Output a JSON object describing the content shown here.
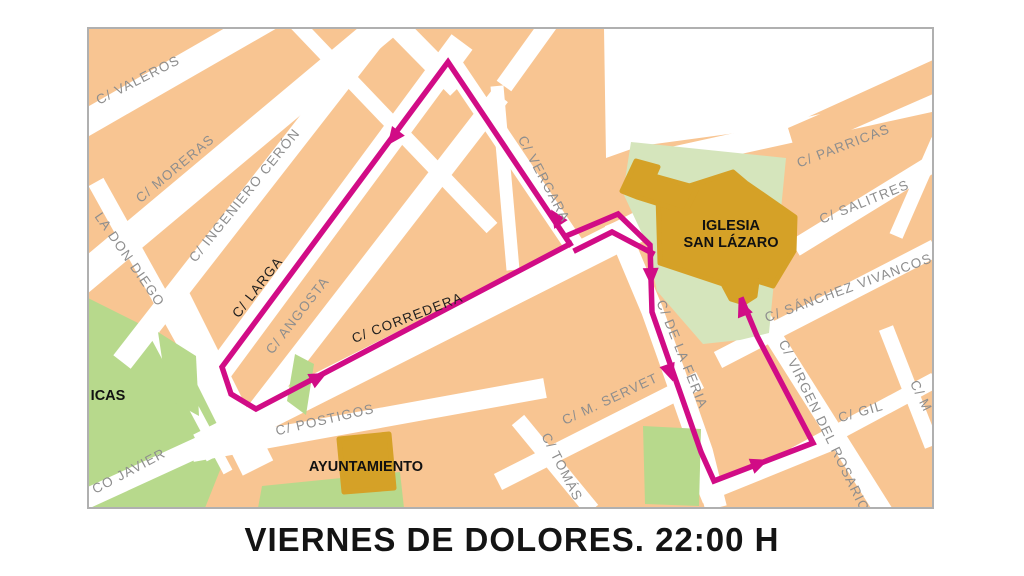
{
  "title": "VIERNES DE DOLORES. 22:00 H",
  "colors": {
    "block_orange": "#f8c592",
    "plaza_green": "#b7d98c",
    "pale_green": "#d5e5bc",
    "building_gold": "#d5a127",
    "street_white": "#ffffff",
    "route_magenta": "#d10c86",
    "label_gray": "#8e8e8e",
    "label_black": "#1f1f1f",
    "poi_black": "#111111",
    "frame_border": "#b0b0b0"
  },
  "map": {
    "frame": {
      "x": 88,
      "y": 28,
      "w": 845,
      "h": 480
    },
    "greens_under": [
      {
        "name": "plaza-green-west",
        "points": [
          [
            88,
            298
          ],
          [
            152,
            330
          ],
          [
            212,
            392
          ],
          [
            232,
            440
          ],
          [
            205,
            508
          ],
          [
            88,
            508
          ]
        ]
      }
    ],
    "streets": [
      {
        "name": "street-valeros",
        "pts": [
          [
            70,
            132
          ],
          [
            272,
            16
          ]
        ],
        "w": 26
      },
      {
        "name": "street-moreras",
        "pts": [
          [
            66,
            292
          ],
          [
            398,
            14
          ]
        ],
        "w": 30
      },
      {
        "name": "street-ingeniero-ceron",
        "pts": [
          [
            122,
            362
          ],
          [
            390,
            18
          ]
        ],
        "w": 22
      },
      {
        "name": "street-larga",
        "pts": [
          [
            205,
            390
          ],
          [
            462,
            42
          ]
        ],
        "w": 26
      },
      {
        "name": "street-angosta",
        "pts": [
          [
            248,
            422
          ],
          [
            500,
            96
          ]
        ],
        "w": 20
      },
      {
        "name": "street-corredera",
        "pts": [
          [
            200,
            448
          ],
          [
            648,
            222
          ]
        ],
        "w": 30
      },
      {
        "name": "street-vergara",
        "pts": [
          [
            448,
            58
          ],
          [
            580,
            254
          ]
        ],
        "w": 20
      },
      {
        "name": "street-top-1",
        "pts": [
          [
            393,
            22
          ],
          [
            458,
            88
          ]
        ],
        "w": 22
      },
      {
        "name": "street-top-2",
        "pts": [
          [
            550,
            22
          ],
          [
            504,
            86
          ]
        ],
        "w": 18
      },
      {
        "name": "street-mid-vert",
        "pts": [
          [
            497,
            86
          ],
          [
            513,
            270
          ]
        ],
        "w": 13
      },
      {
        "name": "street-cross-nw",
        "pts": [
          [
            295,
            22
          ],
          [
            492,
            228
          ]
        ],
        "w": 15
      },
      {
        "name": "street-don-diego",
        "pts": [
          [
            96,
            182
          ],
          [
            235,
            432
          ]
        ],
        "w": 17
      },
      {
        "name": "street-plaza-gap",
        "pts": [
          [
            148,
            322
          ],
          [
            228,
            472
          ]
        ],
        "w": 10
      },
      {
        "name": "street-plaza-band",
        "pts": [
          [
            168,
            288
          ],
          [
            258,
            468
          ]
        ],
        "w": 34
      },
      {
        "name": "street-postigos",
        "pts": [
          [
            192,
            452
          ],
          [
            545,
            388
          ]
        ],
        "w": 20
      },
      {
        "name": "street-javier",
        "pts": [
          [
            66,
            508
          ],
          [
            258,
            420
          ]
        ],
        "w": 20
      },
      {
        "name": "street-feria",
        "pts": [
          [
            615,
            222
          ],
          [
            652,
            310
          ],
          [
            668,
            355
          ],
          [
            702,
            452
          ],
          [
            716,
            508
          ]
        ],
        "w": 22
      },
      {
        "name": "street-servet",
        "pts": [
          [
            498,
            482
          ],
          [
            700,
            380
          ]
        ],
        "w": 18
      },
      {
        "name": "street-tomas",
        "pts": [
          [
            518,
            420
          ],
          [
            592,
            510
          ]
        ],
        "w": 16
      },
      {
        "name": "street-bottom-right",
        "pts": [
          [
            700,
            496
          ],
          [
            838,
            440
          ]
        ],
        "w": 16
      },
      {
        "name": "street-rosario",
        "pts": [
          [
            748,
            296
          ],
          [
            884,
            512
          ]
        ],
        "w": 18
      },
      {
        "name": "street-vivancos",
        "pts": [
          [
            718,
            360
          ],
          [
            935,
            248
          ]
        ],
        "w": 18
      },
      {
        "name": "street-gil",
        "pts": [
          [
            795,
            455
          ],
          [
            935,
            380
          ]
        ],
        "w": 16
      },
      {
        "name": "street-m",
        "pts": [
          [
            886,
            328
          ],
          [
            932,
            446
          ]
        ],
        "w": 15
      },
      {
        "name": "street-parricas",
        "pts": [
          [
            640,
            165
          ],
          [
            935,
            100
          ]
        ],
        "w": 22
      },
      {
        "name": "street-salitres",
        "pts": [
          [
            795,
            248
          ],
          [
            935,
            162
          ]
        ],
        "w": 18
      },
      {
        "name": "street-ne-edge",
        "pts": [
          [
            938,
            140
          ],
          [
            896,
            236
          ]
        ],
        "w": 14
      }
    ],
    "white_patches": [
      {
        "name": "white-ne-corner",
        "points": [
          [
            604,
            28
          ],
          [
            933,
            28
          ],
          [
            933,
            60
          ],
          [
            788,
            126
          ],
          [
            640,
            146
          ],
          [
            606,
            158
          ]
        ]
      }
    ],
    "orange_patches": [
      {
        "name": "block-ne-strip",
        "points": [
          [
            788,
            128
          ],
          [
            931,
            66
          ],
          [
            933,
            94
          ],
          [
            796,
            154
          ]
        ]
      }
    ],
    "greens_over": [
      {
        "name": "green-wedge-1",
        "points": [
          [
            158,
            332
          ],
          [
            196,
            356
          ],
          [
            199,
            416
          ],
          [
            168,
            399
          ]
        ]
      },
      {
        "name": "green-wedge-2",
        "points": [
          [
            295,
            354
          ],
          [
            314,
            364
          ],
          [
            306,
            415
          ],
          [
            287,
            401
          ]
        ]
      },
      {
        "name": "green-church-block",
        "pale": true,
        "points": [
          [
            631,
            142
          ],
          [
            786,
            158
          ],
          [
            769,
            333
          ],
          [
            740,
            340
          ],
          [
            703,
            344
          ],
          [
            657,
            291
          ],
          [
            646,
            242
          ],
          [
            623,
            193
          ]
        ]
      },
      {
        "name": "green-bottom-strip-1",
        "points": [
          [
            262,
            486
          ],
          [
            400,
            472
          ],
          [
            404,
            508
          ],
          [
            258,
            508
          ]
        ]
      },
      {
        "name": "green-bottom-strip-2",
        "points": [
          [
            643,
            426
          ],
          [
            701,
            429
          ],
          [
            699,
            506
          ],
          [
            645,
            504
          ]
        ]
      }
    ],
    "gold_buildings": [
      {
        "name": "building-iglesia-san-lazaro",
        "points": [
          [
            658,
            196
          ],
          [
            733,
            172
          ],
          [
            746,
            183
          ],
          [
            795,
            217
          ],
          [
            794,
            251
          ],
          [
            773,
            286
          ],
          [
            757,
            281
          ],
          [
            755,
            296
          ],
          [
            744,
            303
          ],
          [
            731,
            299
          ],
          [
            723,
            284
          ],
          [
            660,
            263
          ]
        ]
      },
      {
        "name": "building-annex-nw",
        "points": [
          [
            622,
            191
          ],
          [
            636,
            161
          ],
          [
            658,
            167
          ],
          [
            654,
            176
          ],
          [
            697,
            188
          ],
          [
            685,
            212
          ],
          [
            637,
            197
          ]
        ]
      },
      {
        "name": "building-ayuntamiento",
        "points": [
          [
            339,
            439
          ],
          [
            389,
            434
          ],
          [
            394,
            488
          ],
          [
            344,
            492
          ]
        ]
      }
    ],
    "route": {
      "width": 5.5,
      "paths": [
        {
          "name": "route-west-loop",
          "points": [
            [
              570,
              244
            ],
            [
              448,
              62
            ],
            [
              222,
              367
            ],
            [
              231,
              394
            ],
            [
              256,
              409
            ],
            [
              570,
              244
            ]
          ]
        },
        {
          "name": "route-church-outbound",
          "points": [
            [
              652,
              253
            ],
            [
              612,
              232
            ],
            [
              576,
              250
            ]
          ]
        },
        {
          "name": "route-return-east",
          "points": [
            [
              566,
              236
            ],
            [
              618,
              214
            ],
            [
              650,
              245
            ],
            [
              652,
              312
            ],
            [
              667,
              355
            ],
            [
              701,
              452
            ],
            [
              714,
              481
            ],
            [
              813,
              443
            ],
            [
              757,
              336
            ],
            [
              742,
              300
            ]
          ]
        }
      ],
      "arrows": [
        {
          "name": "arrow-up-vergara",
          "x": 556,
          "y": 217,
          "angle": -123.5
        },
        {
          "name": "arrow-down-larga",
          "x": 393,
          "y": 138,
          "angle": 127
        },
        {
          "name": "arrow-up-corredera",
          "x": 319,
          "y": 377,
          "angle": -27.5
        },
        {
          "name": "arrow-down-feria-1",
          "x": 651,
          "y": 277,
          "angle": 88
        },
        {
          "name": "arrow-down-feria-2",
          "x": 670,
          "y": 373,
          "angle": 71
        },
        {
          "name": "arrow-east-bottom",
          "x": 760,
          "y": 463,
          "angle": -21
        },
        {
          "name": "arrow-up-rosario",
          "x": 742,
          "y": 307,
          "angle": -112
        }
      ]
    },
    "street_labels": [
      {
        "name": "label-valeros",
        "text": "C/ VALEROS",
        "x": 140,
        "y": 84,
        "rot": -27,
        "color": "gray"
      },
      {
        "name": "label-moreras",
        "text": "C/ MORERAS",
        "x": 178,
        "y": 172,
        "rot": -40,
        "color": "gray"
      },
      {
        "name": "label-ingeniero-ceron",
        "text": "C/ INGENIERO CERÓN",
        "x": 248,
        "y": 198,
        "rot": -51,
        "color": "gray"
      },
      {
        "name": "label-don-diego",
        "text": "LA DON DIEGO",
        "x": 126,
        "y": 262,
        "rot": 55,
        "color": "gray"
      },
      {
        "name": "label-larga",
        "text": "C/ LARGA",
        "x": 261,
        "y": 290,
        "rot": -52,
        "color": "black"
      },
      {
        "name": "label-angosta",
        "text": "C/ ANGOSTA",
        "x": 301,
        "y": 318,
        "rot": -52,
        "color": "gray"
      },
      {
        "name": "label-corredera",
        "text": "C/ CORREDERA",
        "x": 409,
        "y": 322,
        "rot": -21,
        "color": "black"
      },
      {
        "name": "label-vergara",
        "text": "C/ VERGARA",
        "x": 540,
        "y": 181,
        "rot": 62,
        "color": "gray"
      },
      {
        "name": "label-postigos",
        "text": "C/ POSTIGOS",
        "x": 326,
        "y": 424,
        "rot": -13,
        "color": "gray"
      },
      {
        "name": "label-javier",
        "text": "CO  JAVIER",
        "x": 131,
        "y": 475,
        "rot": -28,
        "color": "gray"
      },
      {
        "name": "label-servet",
        "text": "C/ M. SERVET",
        "x": 612,
        "y": 403,
        "rot": -25,
        "color": "gray"
      },
      {
        "name": "label-tomas",
        "text": "C/ TOMÁS",
        "x": 558,
        "y": 469,
        "rot": 63,
        "color": "gray"
      },
      {
        "name": "label-feria",
        "text": "C/ DE LA FERIA",
        "x": 678,
        "y": 356,
        "rot": 68,
        "color": "gray"
      },
      {
        "name": "label-rosario",
        "text": "C/ VIRGEN DEL ROSARIO",
        "x": 820,
        "y": 428,
        "rot": 64,
        "color": "gray"
      },
      {
        "name": "label-gil",
        "text": "C/  GIL",
        "x": 862,
        "y": 416,
        "rot": -16,
        "color": "gray"
      },
      {
        "name": "label-m",
        "text": "C/ M",
        "x": 917,
        "y": 398,
        "rot": 64,
        "color": "gray"
      },
      {
        "name": "label-vivancos",
        "text": "C/ SÁNCHEZ VIVANCOS",
        "x": 850,
        "y": 292,
        "rot": -20,
        "color": "gray"
      },
      {
        "name": "label-salitres",
        "text": "C/ SALITRES",
        "x": 866,
        "y": 206,
        "rot": -22,
        "color": "gray"
      },
      {
        "name": "label-parricas",
        "text": "C/ PARRICAS",
        "x": 845,
        "y": 150,
        "rot": -21,
        "color": "gray"
      }
    ],
    "poi_labels": [
      {
        "name": "label-icas",
        "text": "ICAS",
        "x": 108,
        "y": 400
      },
      {
        "name": "label-ayuntamiento",
        "text": "AYUNTAMIENTO",
        "x": 366,
        "y": 471
      },
      {
        "name": "label-iglesia-line1",
        "text": "IGLESIA",
        "x": 731,
        "y": 230
      },
      {
        "name": "label-iglesia-line2",
        "text": "SAN LÁZARO",
        "x": 731,
        "y": 247
      }
    ]
  }
}
